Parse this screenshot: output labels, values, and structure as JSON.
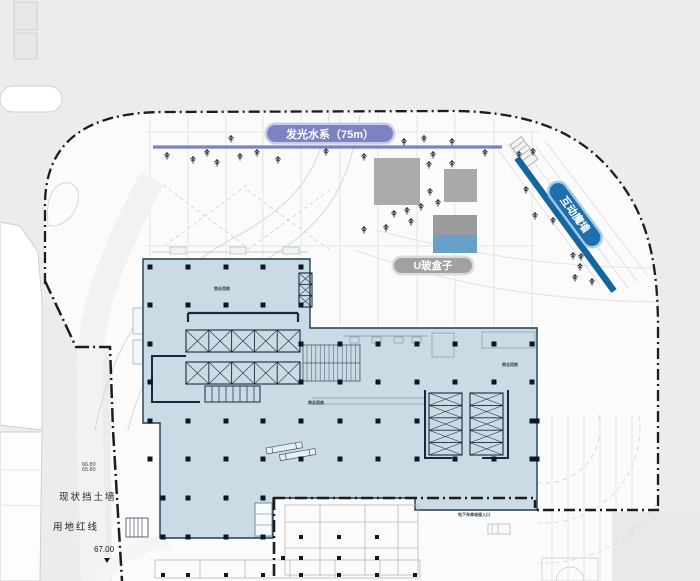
{
  "labels": {
    "water_system": "发光水系（75m）",
    "u_glass_box": "U玻盒子",
    "interactive_wall": "互动魔墙"
  },
  "side_labels": {
    "retaining_wall": "现状挡土墙",
    "site_red_line": "用地红线"
  },
  "elevations": {
    "spot_main": "67.00",
    "spot_upper": "66.80",
    "spot_lower": "65.80"
  },
  "notes": [
    {
      "text": "商业用房",
      "x": 214,
      "y": 286
    },
    {
      "text": "商业用房",
      "x": 308,
      "y": 400
    },
    {
      "text": "商业用房",
      "x": 502,
      "y": 362
    },
    {
      "text": "地下车库坡道入口",
      "x": 458,
      "y": 512
    }
  ],
  "palette": {
    "water_purple": "#7d83c1",
    "wall_blue_line": "#15669f",
    "wall_pill_blue": "#1d6fad",
    "u_glass_blue": "#68a0c9",
    "box_gray": "#ababab",
    "pill_gray": "#a1a1a1",
    "building_fill": "#cadbe6",
    "building_outline": "#1f3a52",
    "boundary_black": "#1c1c1c",
    "background_gray": "#ececec",
    "site_white": "#fbfbfb"
  },
  "plan": {
    "trees": [
      [
        167,
        156
      ],
      [
        193,
        160
      ],
      [
        207,
        153
      ],
      [
        217,
        163
      ],
      [
        231,
        139
      ],
      [
        240,
        157
      ],
      [
        257,
        153
      ],
      [
        278,
        160
      ],
      [
        326,
        152
      ],
      [
        364,
        157
      ],
      [
        404,
        142
      ],
      [
        424,
        139
      ],
      [
        433,
        155
      ],
      [
        452,
        142
      ],
      [
        485,
        153
      ],
      [
        519,
        155
      ],
      [
        533,
        152
      ],
      [
        429,
        165
      ],
      [
        452,
        164
      ],
      [
        430,
        192
      ],
      [
        438,
        203
      ],
      [
        421,
        207
      ],
      [
        407,
        211
      ],
      [
        394,
        214
      ],
      [
        411,
        222
      ],
      [
        386,
        228
      ],
      [
        364,
        230
      ],
      [
        526,
        190
      ],
      [
        535,
        216
      ],
      [
        553,
        221
      ],
      [
        573,
        256
      ],
      [
        581,
        257
      ],
      [
        580,
        267
      ],
      [
        575,
        278
      ],
      [
        592,
        282
      ]
    ],
    "columns": [
      [
        150,
        267
      ],
      [
        188,
        267
      ],
      [
        226,
        267
      ],
      [
        263,
        267
      ],
      [
        301,
        267
      ],
      [
        150,
        305
      ],
      [
        188,
        305
      ],
      [
        226,
        305
      ],
      [
        263,
        305
      ],
      [
        301,
        305
      ],
      [
        150,
        344
      ],
      [
        301,
        344
      ],
      [
        340,
        344
      ],
      [
        378,
        344
      ],
      [
        417,
        344
      ],
      [
        455,
        344
      ],
      [
        494,
        344
      ],
      [
        532,
        344
      ],
      [
        150,
        382
      ],
      [
        301,
        382
      ],
      [
        340,
        382
      ],
      [
        378,
        382
      ],
      [
        417,
        382
      ],
      [
        455,
        382
      ],
      [
        494,
        382
      ],
      [
        532,
        382
      ],
      [
        150,
        421
      ],
      [
        188,
        421
      ],
      [
        226,
        421
      ],
      [
        263,
        421
      ],
      [
        301,
        421
      ],
      [
        340,
        421
      ],
      [
        378,
        421
      ],
      [
        417,
        421
      ],
      [
        532,
        421
      ],
      [
        150,
        459
      ],
      [
        188,
        459
      ],
      [
        226,
        459
      ],
      [
        263,
        459
      ],
      [
        301,
        459
      ],
      [
        340,
        459
      ],
      [
        378,
        459
      ],
      [
        417,
        459
      ],
      [
        455,
        459
      ],
      [
        494,
        459
      ],
      [
        532,
        459
      ],
      [
        163,
        498
      ],
      [
        188,
        498
      ],
      [
        226,
        498
      ],
      [
        263,
        498
      ],
      [
        163,
        537
      ],
      [
        188,
        537
      ],
      [
        226,
        537
      ],
      [
        263,
        537
      ],
      [
        537,
        421
      ],
      [
        537,
        459
      ]
    ],
    "white_columns": [
      [
        301,
        537
      ],
      [
        339,
        537
      ],
      [
        377,
        537
      ],
      [
        283,
        558
      ],
      [
        301,
        558
      ],
      [
        339,
        558
      ],
      [
        377,
        558
      ],
      [
        163,
        575
      ],
      [
        188,
        575
      ],
      [
        226,
        575
      ],
      [
        263,
        575
      ],
      [
        301,
        575
      ],
      [
        339,
        575
      ],
      [
        377,
        575
      ],
      [
        415,
        575
      ]
    ],
    "boxes": [
      {
        "x": 374,
        "y": 158,
        "w": 46,
        "h": 47,
        "color": "#ababab"
      },
      {
        "x": 444,
        "y": 169,
        "w": 33,
        "h": 33,
        "color": "#a9a9a9"
      },
      {
        "x": 433,
        "y": 215,
        "w": 44,
        "h": 20,
        "color": "#9b9b9b"
      },
      {
        "x": 433,
        "y": 235,
        "w": 44,
        "h": 18,
        "color": "#68a0c9"
      }
    ],
    "water_line": {
      "x1": 153,
      "y": 147,
      "x2": 502
    }
  }
}
